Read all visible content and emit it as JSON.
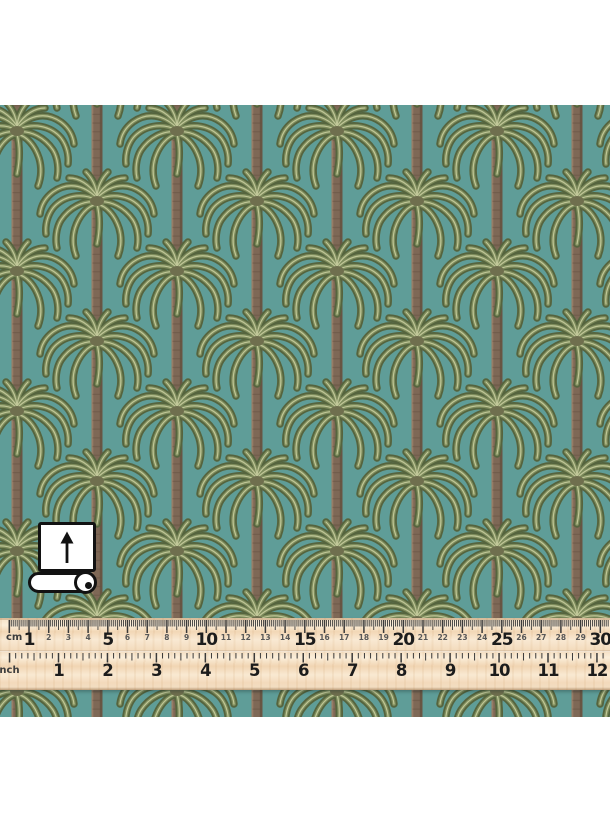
{
  "image": {
    "type": "fabric product photo",
    "subject": "Palm tree repeat pattern fabric swatch with roll-direction icon and wooden ruler"
  },
  "swatch": {
    "pattern_name": "palm-trees-half-drop-repeat",
    "colors": {
      "background": "#5f9d98",
      "frond_dark": "#55643e",
      "frond_mid": "#7e8c5c",
      "frond_pale": "#ccd1a2",
      "crown": "#6f6f4e",
      "trunk": "#7e6856",
      "trunk_shadow": "#63503f",
      "trunk_highlight": "#9a8068"
    }
  },
  "roll_icon": {
    "meaning": "fabric roll with print direction arrow",
    "arrow_direction": "up"
  },
  "ruler": {
    "wood_color": "#f8e8d2",
    "tick_color": "#3a3a3a",
    "number_color": "#1c1c1c",
    "minor_number_color": "#575757",
    "cm": {
      "label": "cm",
      "numbers": [
        1,
        2,
        3,
        4,
        5,
        6,
        7,
        8,
        9,
        10,
        11,
        12,
        13,
        14,
        15,
        16,
        17,
        18,
        19,
        20,
        21,
        22,
        23,
        24,
        25,
        26,
        27,
        28,
        29,
        30
      ],
      "major_numbers": [
        1,
        5,
        10,
        15,
        20,
        25,
        30
      ]
    },
    "inch": {
      "label": "inch",
      "numbers": [
        1,
        2,
        3,
        4,
        5,
        6,
        7,
        8,
        9,
        10,
        11,
        12
      ]
    }
  }
}
